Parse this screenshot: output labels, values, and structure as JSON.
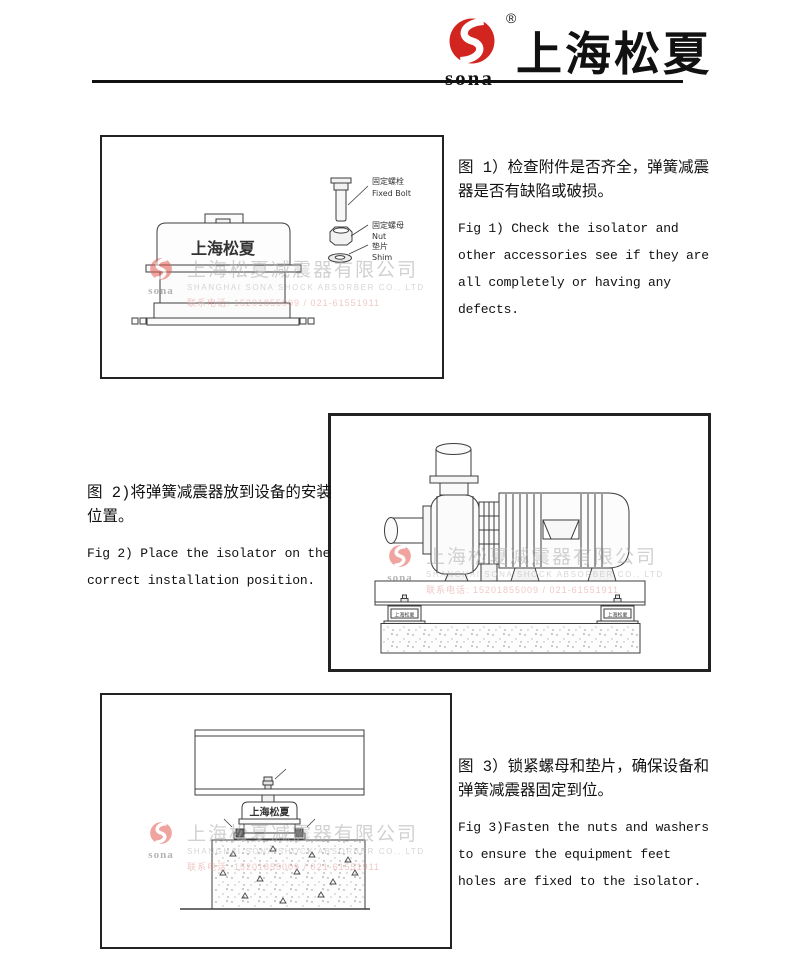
{
  "header": {
    "logo_text": "sona",
    "registered": "®",
    "brand_cn": "上海松夏",
    "logo_color": "#d2251f"
  },
  "watermark": {
    "logo_text": "sona",
    "company_cn": "上海松夏减震器有限公司",
    "company_en": "SHANGHAI SONA SHOCK ABSORBER CO., LTD",
    "tel": "联系电话: 15201855009 / 021-61551911"
  },
  "figures": [
    {
      "device_label": "上海松夏",
      "parts": {
        "bolt_cn": "固定螺栓",
        "bolt_en": "Fixed Bolt",
        "nut_cn": "固定螺母",
        "nut_en": "Nut",
        "shim_cn": "垫片",
        "shim_en": "Shim"
      },
      "caption_cn": "图 1）检查附件是否齐全，弹簧减震\n器是否有缺陷或破损。",
      "caption_en": "Fig 1) Check the isolator and\nother accessories see if they are\nall completely or having any\ndefects."
    },
    {
      "isolator_label": "上海松夏",
      "caption_cn": "图 2)将弹簧减震器放到设备的安装\n位置。",
      "caption_en": "Fig 2) Place the isolator on the\ncorrect installation position."
    },
    {
      "device_label": "上海松夏",
      "caption_cn": "图 3）锁紧螺母和垫片，确保设备和\n弹簧减震器固定到位。",
      "caption_en": "Fig 3)Fasten the nuts and washers\nto ensure the equipment feet\nholes are fixed to the isolator."
    }
  ]
}
